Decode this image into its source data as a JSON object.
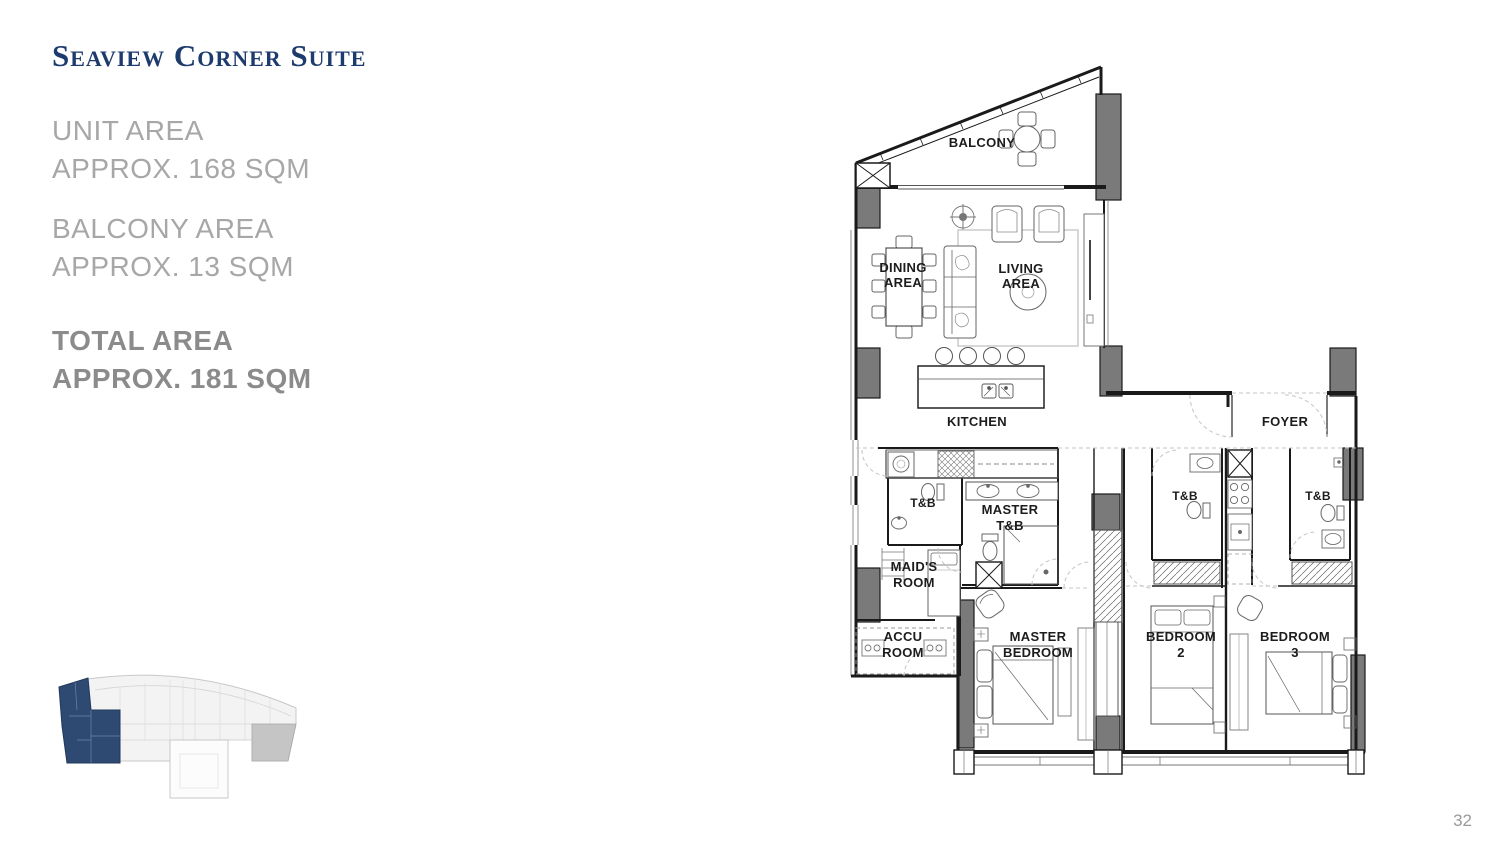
{
  "page": {
    "title": "Seaview Corner Suite",
    "page_number": "32"
  },
  "areas": {
    "unit_area": {
      "label": "UNIT AREA",
      "value": "APPROX. 168 SQM"
    },
    "balcony_area": {
      "label": "BALCONY AREA",
      "value": "APPROX. 13 SQM"
    },
    "total_area": {
      "label": "TOTAL AREA",
      "value": "APPROX. 181 SQM"
    }
  },
  "floor_plan": {
    "rooms": [
      {
        "id": "balcony",
        "lines": [
          "BALCONY"
        ]
      },
      {
        "id": "dining-area",
        "lines": [
          "DINING",
          "AREA"
        ]
      },
      {
        "id": "living-area",
        "lines": [
          "LIVING",
          "AREA"
        ]
      },
      {
        "id": "kitchen",
        "lines": [
          "KITCHEN"
        ]
      },
      {
        "id": "foyer",
        "lines": [
          "FOYER"
        ]
      },
      {
        "id": "maids-tb",
        "lines": [
          "T&B"
        ]
      },
      {
        "id": "master-tb",
        "lines": [
          "MASTER",
          "T&B"
        ]
      },
      {
        "id": "maids-room",
        "lines": [
          "MAID'S",
          "ROOM"
        ]
      },
      {
        "id": "accu-room",
        "lines": [
          "ACCU",
          "ROOM"
        ]
      },
      {
        "id": "master-bedroom",
        "lines": [
          "MASTER",
          "BEDROOM"
        ]
      },
      {
        "id": "bedroom-2",
        "lines": [
          "BEDROOM",
          "2"
        ]
      },
      {
        "id": "bedroom-3",
        "lines": [
          "BEDROOM",
          "3"
        ]
      },
      {
        "id": "bedroom2-tb",
        "lines": [
          "T&B"
        ]
      },
      {
        "id": "bedroom3-tb",
        "lines": [
          "T&B"
        ]
      }
    ]
  },
  "colors": {
    "title_navy": "#1d3c6d",
    "keyplan_highlight": "#2e4a72",
    "area_text_gray": "#a7a7a7",
    "total_text_gray": "#8b8b8b",
    "plan_line": "#1c1c1c",
    "column_gray": "#7a7a7a",
    "page_number_gray": "#9a9a9a"
  }
}
